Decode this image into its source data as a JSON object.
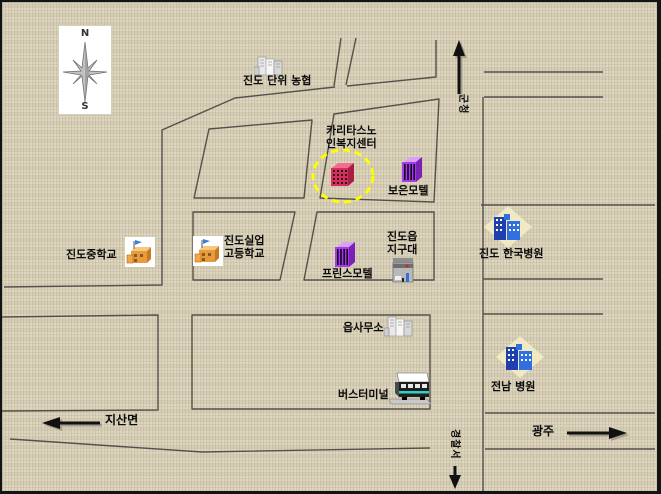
{
  "compass": {
    "north": "N",
    "south": "S"
  },
  "places": {
    "nonghyup": {
      "label": "진도 단위 농협",
      "icon": "gray-buildings-icon"
    },
    "caritas": {
      "line1": "카리타스노",
      "line2": "인복지센터",
      "icon": "red-building-icon",
      "highlight": "yellow-dashed-circle"
    },
    "boeun_motel": {
      "label": "보은모텔",
      "icon": "purple-building-icon"
    },
    "middle_school": {
      "label": "진도중학교",
      "icon": "school-blocks-icon"
    },
    "silup_school": {
      "line1": "진도실업",
      "line2": "고등학교",
      "icon": "school-blocks-icon"
    },
    "prince_motel": {
      "label": "프린스모텔",
      "icon": "purple-building-icon"
    },
    "jigudae": {
      "line1": "진도읍",
      "line2": "지구대",
      "icon": "police-box-icon"
    },
    "hankook_hospital": {
      "label": "진도 한국병원",
      "icon": "blue-hospital-icon"
    },
    "eup_office": {
      "label": "읍사무소",
      "icon": "gray-buildings-icon"
    },
    "bus_terminal": {
      "label": "버스터미널",
      "icon": "bus-icon"
    },
    "jeonnam_hospital": {
      "label": "전남 병원",
      "icon": "blue-hospital-icon"
    }
  },
  "directions": {
    "gun_office": {
      "label": "군청",
      "arrow": "up"
    },
    "police": {
      "label": "경찰서",
      "arrow": "down"
    },
    "jisan": {
      "label": "지산면",
      "arrow": "left"
    },
    "gwangju": {
      "label": "광주",
      "arrow": "right"
    }
  },
  "colors": {
    "background": "#ddd4bd",
    "road": "#55514a",
    "highlight": "#ffff00",
    "motel_purple": "#a43ce8",
    "caritas_red": "#d62e57",
    "hospital_blue": "#2f6fe0",
    "arrow_black": "#111111"
  }
}
